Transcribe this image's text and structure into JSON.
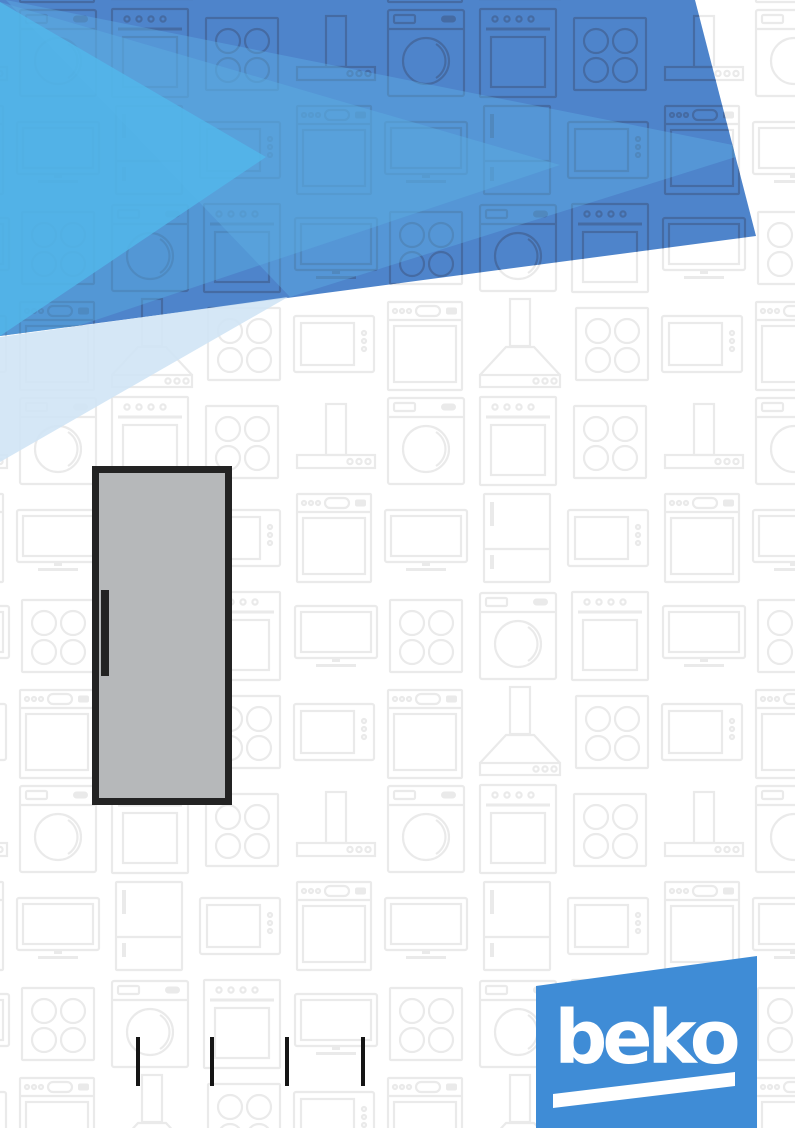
{
  "document": {
    "kind": "appliance-manual-cover",
    "page_width_px": 795,
    "page_height_px": 1128
  },
  "brand": {
    "logo_text": "beko"
  },
  "illustration": {
    "subject": "upright-refrigerator-single-door",
    "handle_side": "left"
  },
  "registration_marks": {
    "count": 4
  },
  "background_pattern": {
    "description": "light gray outline icons of home appliances tiled over the page",
    "glyphs": [
      "washing-machine",
      "built-in-oven",
      "cooktop-hob",
      "flat-screen-tv",
      "cooker-hood-flat",
      "cooker-hood-pyramid",
      "microwave-oven",
      "dishwasher",
      "fridge-freezer"
    ]
  },
  "colors": {
    "background": "#ffffff",
    "logo_blue": "#3f8cd6",
    "logo_text_white": "#ffffff",
    "header_base_blue": "#4e84cb",
    "header_cyan": "#52b6ea",
    "header_light_blue": "#58aadf",
    "header_band_blue": "#5fb0e4",
    "header_pale_blue": "#cfe4f5",
    "pattern_gray": "#eaeaea",
    "pattern_blue_tint": "#44689f",
    "fridge_body_gray": "#b6b8ba",
    "fridge_outline": "#232323",
    "mark_black": "#151515"
  }
}
